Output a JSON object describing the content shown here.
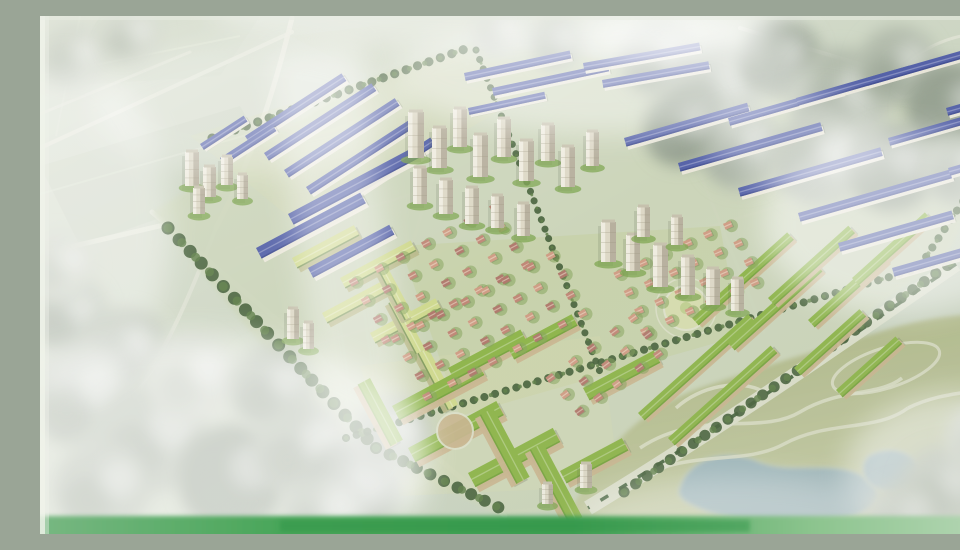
{
  "scene_description": "Aerial bird's-eye architectural rendering of a large new urban residential masterplan, photographed from a printed presentation board with glass glare; blue-roof rowhouse bands, beige high-rise towers, pink-roof villa grids, green-roof apartment blocks, tree-lined boulevard and a landscaped park with lake at lower right",
  "palette": {
    "bg1": "#d8decf",
    "bg2": "#c3cebb",
    "fieldLine": "#e6eada",
    "patchA": "#c2cdb9",
    "patchB": "#cfd8c6",
    "patchC": "#d2dac6",
    "estateBase": "#ccd5ba",
    "lawn": "#c0cf92",
    "lawnLight": "#d6dcae",
    "roadLight": "#e4e6d8",
    "treeGreyLt": "#cdd3c6",
    "treeGrey": "#b2bbac",
    "treeGreyDk": "#97a292",
    "treeDkGreen": "#46613b",
    "treeMdGreen": "#5f7f49",
    "roofBlue": "#5562a8",
    "roofBlueDk": "#3f4a8c",
    "facade": "#ece9dc",
    "towerFill": "#ddd8c6",
    "towerShade": "#b0a996",
    "towerHi": "#f4f1e6",
    "towerGreen": "#7fa651",
    "roofGreen": "#8eb54b",
    "roofGreenDk": "#6f9c3c",
    "blockSide": "#c9b690",
    "schoolRoof": "#cfd98f",
    "schoolSide": "#b9b98a",
    "villaRoof": "#c08877",
    "villaRoof2": "#cf9d85",
    "villaRoof3": "#b07a6d",
    "villaGreen": "#86a45e",
    "parkOlive1": "#a7b07c",
    "parkOlive2": "#c9cfa9",
    "lake": "#9db6bf",
    "lakeEdge": "#c3cdb9",
    "pathCream": "#dde0ca",
    "boulevardFill": "#dcdfcc",
    "medianGreen": "#3f5d37",
    "bandGreen1": "#79b883",
    "bandGreen2": "#3f9f52",
    "bandGreen3": "#b9d8b8",
    "frameBeige": "#c3b99f",
    "edgeWhite": "#f0f3ea",
    "glare": "#ffffff"
  },
  "scene": {
    "estate_outline": "112,196 330,62 432,26 700,60 950,94 950,146 906,242 548,492 462,500 300,424",
    "lawn_zones": [
      {
        "points": "360,230 680,210 700,320 420,400",
        "c": "lawn",
        "o": 0.35
      },
      {
        "points": "320,350 560,320 580,470 360,480",
        "c": "lawnLight",
        "o": 0.3
      },
      {
        "points": "150,120 430,30 520,60 260,210",
        "c": "lawnLight",
        "o": 0.25
      }
    ],
    "field_patches": [
      {
        "points": "0,150 200,90 240,160 40,230",
        "c": "patchA",
        "o": 0.4
      },
      {
        "points": "60,0 220,0 180,60 20,70",
        "c": "patchB",
        "o": 0.5
      },
      {
        "points": "250,20 420,0 560,0 330,60",
        "c": "patchC",
        "o": 0.45
      }
    ],
    "field_lines": [
      {
        "d": "M0,60 L200,20",
        "o": 0.4
      },
      {
        "d": "M0,178 L210,118",
        "o": 0.35
      },
      {
        "d": "M40,0 L16,120",
        "o": 0.3
      }
    ],
    "roads": [
      {
        "d": "M0,132 L252,16",
        "w": 4,
        "o": 0.8
      },
      {
        "d": "M0,98 L150,36",
        "w": 3,
        "o": 0.6
      },
      {
        "d": "M252,2 C232,84 212,142 176,212",
        "w": 5,
        "o": 0.9
      },
      {
        "d": "M0,238 L128,208",
        "w": 5,
        "o": 0.85
      },
      {
        "d": "M176,212 C150,280 128,330 94,382",
        "w": 4,
        "o": 0.6
      },
      {
        "d": "M700,12 L849,57",
        "w": 4,
        "o": 0.8
      },
      {
        "d": "M879,76 L952,122",
        "w": 4,
        "o": 0.8
      },
      {
        "d": "M864,48 C898,22 930,14 958,20",
        "w": 3,
        "o": 0.7
      },
      {
        "d": "M432,32 L312,426",
        "w": 4,
        "o": 0.5
      },
      {
        "d": "M112,196 L465,500",
        "w": 5,
        "o": 0.7
      },
      {
        "d": "M196,232 L648,94",
        "w": 3,
        "o": 0.5
      },
      {
        "d": "M256,334 L806,170",
        "w": 3,
        "o": 0.5
      },
      {
        "d": "M620,58 L724,316",
        "w": 3,
        "o": 0.45
      },
      {
        "d": "M788,88 L884,238",
        "w": 3,
        "o": 0.45
      }
    ],
    "roundabout": {
      "cx": 864,
      "cy": 66,
      "r": 15
    },
    "boulevard": {
      "d": "M916,248 C840,300 700,400 548,492",
      "width": 15
    },
    "park": {
      "outline": "M520,518 C556,436 598,394 660,372 C724,350 792,330 852,312 C902,298 940,296 960,302 L960,518 Z"
    },
    "lakes": [
      "M640,470 C650,440 690,432 720,446 C750,458 790,444 820,458 C850,472 840,496 805,502 C760,508 700,506 668,496 C646,488 634,482 640,470 Z",
      "M828,440 C848,428 874,434 878,452 C882,470 860,480 840,474 C822,468 818,450 828,440 Z"
    ],
    "park_paths": [
      "M600,432 C660,392 720,420 760,396 C800,372 840,380 862,362",
      "M588,470 C640,430 700,452 744,428 C788,404 836,416 868,392",
      "M636,392 C660,370 700,362 724,376",
      "M868,392 C900,376 930,378 956,370"
    ],
    "park_loop": {
      "cx": 846,
      "cy": 352,
      "rx": 56,
      "ry": 20,
      "a": -18
    },
    "parterre": {
      "cx": 646,
      "cy": 292,
      "r": 22
    },
    "grey_trees": [
      [
        618,
        42,
        38,
        1
      ],
      [
        676,
        72,
        46,
        1
      ],
      [
        740,
        42,
        40,
        2
      ],
      [
        800,
        82,
        50,
        1
      ],
      [
        858,
        50,
        40,
        1
      ],
      [
        912,
        92,
        46,
        2
      ],
      [
        702,
        132,
        42,
        1
      ],
      [
        780,
        142,
        48,
        1
      ],
      [
        852,
        152,
        44,
        2
      ],
      [
        920,
        152,
        38,
        1
      ],
      [
        642,
        112,
        38,
        2
      ],
      [
        458,
        16,
        28,
        0
      ],
      [
        516,
        26,
        26,
        1
      ],
      [
        34,
        42,
        34,
        0
      ],
      [
        90,
        20,
        30,
        0
      ],
      [
        28,
        300,
        40,
        1
      ],
      [
        86,
        332,
        40,
        1
      ],
      [
        20,
        250,
        34,
        0
      ],
      [
        42,
        382,
        52,
        1
      ],
      [
        112,
        422,
        56,
        1
      ],
      [
        192,
        462,
        54,
        2
      ],
      [
        62,
        472,
        48,
        1
      ],
      [
        262,
        432,
        48,
        1
      ],
      [
        152,
        362,
        44,
        0
      ],
      [
        232,
        372,
        42,
        1
      ],
      [
        312,
        472,
        46,
        2
      ],
      [
        352,
        420,
        40,
        1
      ],
      [
        282,
        500,
        40,
        1
      ],
      [
        902,
        472,
        42,
        1
      ],
      [
        942,
        422,
        36,
        0
      ],
      [
        862,
        502,
        36,
        1
      ]
    ],
    "tree_lines": [
      {
        "d": "M128,212 L336,432",
        "w": 13
      },
      {
        "d": "M336,432 L470,497",
        "w": 12
      },
      {
        "d": "M172,122 L428,32",
        "w": 9
      },
      {
        "d": "M584,476 L918,242",
        "w": 11
      },
      {
        "d": "M306,422 L900,246",
        "w": 8
      },
      {
        "d": "M436,34 L560,356",
        "w": 7
      },
      {
        "d": "M880,250 L936,166",
        "w": 8
      }
    ],
    "blue_rows": [
      [
        205,
        120,
        115,
        9,
        -33
      ],
      [
        224,
        137,
        128,
        9,
        -33
      ],
      [
        244,
        154,
        132,
        9,
        -33
      ],
      [
        266,
        171,
        128,
        9,
        -33
      ],
      [
        288,
        188,
        122,
        9,
        -33
      ],
      [
        180,
        142,
        62,
        8,
        -33
      ],
      [
        160,
        128,
        52,
        7,
        -33
      ],
      [
        248,
        198,
        148,
        12,
        -28
      ],
      [
        216,
        232,
        118,
        12,
        -28
      ],
      [
        268,
        252,
        92,
        11,
        -28
      ],
      [
        424,
        57,
        108,
        8,
        -12
      ],
      [
        452,
        72,
        118,
        8,
        -12
      ],
      [
        428,
        92,
        78,
        7,
        -12
      ],
      [
        543,
        47,
        118,
        8,
        -10
      ],
      [
        562,
        64,
        108,
        8,
        -10
      ],
      [
        584,
        122,
        128,
        9,
        -16
      ],
      [
        638,
        147,
        148,
        9,
        -16
      ],
      [
        698,
        172,
        148,
        9,
        -16
      ],
      [
        758,
        197,
        158,
        9,
        -16
      ],
      [
        688,
        102,
        118,
        8,
        -16
      ],
      [
        756,
        82,
        118,
        8,
        -16
      ],
      [
        826,
        62,
        108,
        8,
        -16
      ],
      [
        848,
        122,
        98,
        8,
        -16
      ],
      [
        798,
        227,
        118,
        9,
        -16
      ],
      [
        852,
        252,
        98,
        9,
        -16
      ],
      [
        906,
        92,
        48,
        8,
        -16
      ],
      [
        908,
        152,
        44,
        8,
        -16
      ]
    ],
    "school_blocks": [
      [
        252,
        242,
        70,
        12,
        -28
      ],
      [
        300,
        262,
        80,
        12,
        -28
      ],
      [
        282,
        297,
        70,
        12,
        -28
      ],
      [
        330,
        317,
        74,
        12,
        -28
      ],
      [
        358,
        282,
        58,
        11,
        62
      ],
      [
        388,
        332,
        64,
        12,
        62
      ],
      [
        348,
        252,
        54,
        10,
        62
      ]
    ],
    "green_blocks": [
      [
        352,
        390,
        96,
        16,
        -28
      ],
      [
        368,
        432,
        100,
        16,
        -28
      ],
      [
        428,
        457,
        96,
        16,
        -28
      ],
      [
        330,
        362,
        70,
        14,
        62
      ],
      [
        453,
        392,
        78,
        15,
        62
      ],
      [
        503,
        427,
        84,
        15,
        62
      ],
      [
        543,
        372,
        80,
        14,
        -28
      ],
      [
        408,
        352,
        82,
        14,
        -28
      ],
      [
        468,
        332,
        72,
        13,
        -28
      ],
      [
        520,
        455,
        70,
        14,
        -28
      ],
      [
        598,
        397,
        148,
        10,
        -42
      ],
      [
        628,
        422,
        138,
        10,
        -42
      ],
      [
        652,
        302,
        128,
        10,
        -42
      ],
      [
        688,
        327,
        118,
        10,
        -42
      ],
      [
        728,
        282,
        108,
        10,
        -42
      ],
      [
        768,
        304,
        98,
        10,
        -42
      ],
      [
        812,
        262,
        98,
        10,
        -42
      ],
      [
        754,
        352,
        88,
        10,
        -42
      ],
      [
        796,
        374,
        80,
        10,
        -42
      ]
    ],
    "plaza": {
      "cx": 415,
      "cy": 415,
      "r": 18
    },
    "villa_grids": [
      {
        "cx": 400,
        "cy": 258,
        "cols": 7,
        "rows": 4,
        "dx": 26,
        "dy": 21,
        "a": -28,
        "size": 8
      },
      {
        "cx": 450,
        "cy": 310,
        "cols": 8,
        "rows": 4,
        "dx": 25,
        "dy": 21,
        "a": -28,
        "size": 8
      },
      {
        "cx": 648,
        "cy": 262,
        "cols": 6,
        "rows": 4,
        "dx": 24,
        "dy": 20,
        "a": -24,
        "size": 8,
        "warm": true
      },
      {
        "cx": 566,
        "cy": 350,
        "cols": 5,
        "rows": 3,
        "dx": 25,
        "dy": 21,
        "a": -36,
        "size": 8
      }
    ],
    "towers": [
      [
        145,
        136,
        14,
        34
      ],
      [
        163,
        151,
        13,
        30
      ],
      [
        181,
        141,
        12,
        28
      ],
      [
        153,
        172,
        12,
        26
      ],
      [
        197,
        159,
        11,
        24
      ],
      [
        368,
        96,
        16,
        46
      ],
      [
        392,
        112,
        15,
        40
      ],
      [
        413,
        93,
        14,
        38
      ],
      [
        433,
        119,
        15,
        42
      ],
      [
        457,
        103,
        14,
        38
      ],
      [
        479,
        125,
        15,
        40
      ],
      [
        501,
        109,
        14,
        36
      ],
      [
        521,
        131,
        14,
        40
      ],
      [
        546,
        116,
        13,
        34
      ],
      [
        373,
        152,
        14,
        36
      ],
      [
        399,
        164,
        14,
        34
      ],
      [
        425,
        172,
        14,
        36
      ],
      [
        451,
        180,
        13,
        32
      ],
      [
        477,
        188,
        13,
        32
      ],
      [
        561,
        206,
        15,
        40
      ],
      [
        586,
        219,
        14,
        36
      ],
      [
        613,
        229,
        15,
        42
      ],
      [
        641,
        241,
        14,
        38
      ],
      [
        666,
        253,
        14,
        36
      ],
      [
        691,
        263,
        13,
        32
      ],
      [
        597,
        191,
        13,
        30
      ],
      [
        631,
        201,
        12,
        28
      ],
      [
        247,
        293,
        12,
        30
      ],
      [
        263,
        307,
        11,
        26
      ],
      [
        540,
        448,
        12,
        24
      ],
      [
        502,
        468,
        11,
        20
      ]
    ],
    "glare": [
      {
        "t": "e",
        "cx": 470,
        "cy": -8,
        "rx": 300,
        "ry": 46,
        "o": 0.4
      },
      {
        "t": "e",
        "cx": 645,
        "cy": 18,
        "rx": 95,
        "ry": 30,
        "o": 0.5
      },
      {
        "t": "e",
        "cx": 560,
        "cy": 60,
        "rx": 210,
        "ry": 58,
        "o": 0.45
      },
      {
        "t": "e",
        "cx": 760,
        "cy": 122,
        "rx": 95,
        "ry": 46,
        "o": 0.35
      },
      {
        "t": "e",
        "cx": 862,
        "cy": 206,
        "rx": 140,
        "ry": 92,
        "o": 0.5
      },
      {
        "t": "r",
        "x": 262,
        "y": 30,
        "w": 90,
        "h": 470,
        "a": -8,
        "o": 0.4
      },
      {
        "t": "e",
        "cx": 210,
        "cy": 92,
        "rx": 160,
        "ry": 66,
        "o": 0.3
      },
      {
        "t": "e",
        "cx": 150,
        "cy": 438,
        "rx": 240,
        "ry": 120,
        "o": 0.55
      },
      {
        "t": "e",
        "cx": 35,
        "cy": 210,
        "rx": 95,
        "ry": 165,
        "o": 0.4
      },
      {
        "t": "e",
        "cx": 920,
        "cy": 458,
        "rx": 115,
        "ry": 82,
        "o": 0.5
      },
      {
        "t": "e",
        "cx": 700,
        "cy": 505,
        "rx": 160,
        "ry": 45,
        "o": 0.35
      }
    ],
    "bottom_band": {
      "y": 500,
      "h": 18
    },
    "frame": {
      "right_strip_points": "944,0 960,0 960,152 950,152"
    }
  }
}
